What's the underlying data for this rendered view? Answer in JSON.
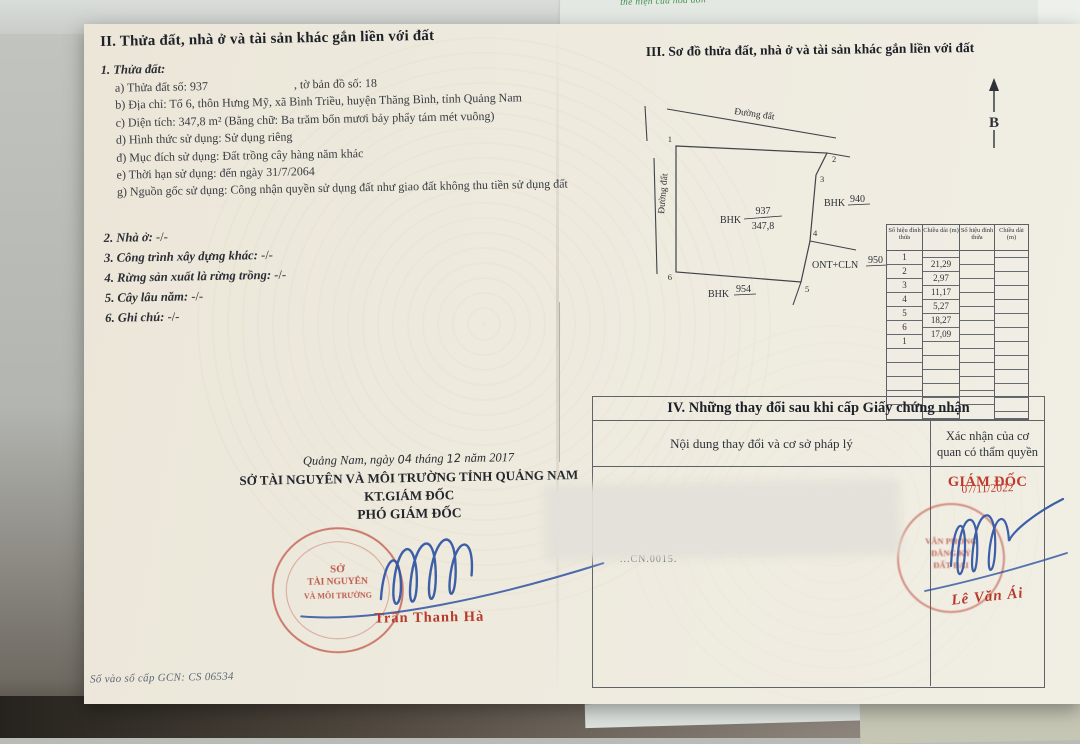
{
  "colors": {
    "stamp_red": "#b63b2c",
    "ink_blue": "#2e52a3",
    "note_green": "#3f8f4f"
  },
  "background": {
    "top_paper_text": "thể hiện của hóa đơn"
  },
  "section_ii": {
    "heading": "II. Thửa đất, nhà ở và tài sản khác gắn liền với đất",
    "item1": "1. Thửa đất:",
    "line_a_left": "a) Thửa đất số: 937",
    "line_a_right": ", tờ bản đồ số: 18",
    "line_b": "b) Địa chỉ: Tổ 6, thôn Hưng Mỹ, xã Bình Triều, huyện Thăng Bình, tỉnh Quảng Nam",
    "line_c": "c) Diện tích: 347,8 m² (Bằng chữ: Ba trăm bốn mươi bảy phẩy tám mét vuông)",
    "line_d": "d) Hình thức sử dụng: Sử dụng riêng",
    "line_dd": "đ) Mục đích sử dụng: Đất trồng cây hàng năm khác",
    "line_e": "e) Thời hạn sử dụng: đến ngày 31/7/2064",
    "line_g": "g) Nguồn gốc sử dụng: Công nhận quyền sử dụng đất như giao đất không thu tiền sử dụng đất",
    "item2": "2. Nhà ở:",
    "item3": "3. Công trình xây dựng khác:",
    "item4": "4. Rừng sản xuất là rừng trồng:",
    "item5": "5. Cây lâu năm:",
    "item6": "6. Ghi chú:",
    "empty_mark": "-/-"
  },
  "signature_block": {
    "date_p1": "Quảng Nam, ngày",
    "date_day": "04",
    "date_p2": "tháng",
    "date_month": "12",
    "date_p3": "năm 2017",
    "department": "SỞ TÀI NGUYÊN VÀ MÔI TRƯỜNG TỈNH QUẢNG NAM",
    "kt_line": "KT.GIÁM ĐỐC",
    "title_line": "PHÓ GIÁM ĐỐC",
    "signer": "Trần Thanh Hà",
    "seal_lines": [
      "SỞ",
      "TÀI NGUYÊN",
      "VÀ MÔI TRƯỜNG"
    ]
  },
  "footer": {
    "text": "Số vào sổ cấp GCN: CS 06534"
  },
  "section_iii": {
    "heading": "III. Sơ đồ thửa đất, nhà ở và tài sản khác gắn liền với đất",
    "north_label": "B",
    "road_top": "Đường đất",
    "road_left": "Đường đất",
    "parcel_main_code": "BHK",
    "parcel_main_no": "937",
    "parcel_main_area": "347,8",
    "parcel_right_code": "BHK",
    "parcel_right_no": "940",
    "parcel_se_code": "ONT+CLN",
    "parcel_se_no": "950",
    "parcel_bottom_code": "BHK",
    "parcel_bottom_no": "954",
    "vertices": [
      "1",
      "2",
      "3",
      "4",
      "5",
      "6"
    ]
  },
  "vertex_table": {
    "col_headers": [
      "Số hiệu đỉnh thửa",
      "Chiều dài (m)",
      "Số hiệu đỉnh thửa",
      "Chiều dài (m)"
    ],
    "vertex_order": [
      "1",
      "2",
      "3",
      "4",
      "5",
      "6",
      "1"
    ],
    "lengths": [
      "21,29",
      "2,97",
      "11,17",
      "5,27",
      "18,27",
      "17,09"
    ]
  },
  "section_iv": {
    "heading": "IV. Những thay đổi sau khi cấp Giấy chứng nhận",
    "col1": "Nội dung thay đổi và cơ sở pháp lý",
    "col2": "Xác nhận của cơ quan có thẩm quyền",
    "stamp_title": "GIÁM ĐỐC",
    "stamp_date": "07/11/2022",
    "signer": "Lê Văn Ái",
    "blur_fragment": "...CN.0015.",
    "seal_lines": [
      "VĂN PHÒNG",
      "ĐĂNG KÝ",
      "ĐẤT ĐAI"
    ]
  }
}
